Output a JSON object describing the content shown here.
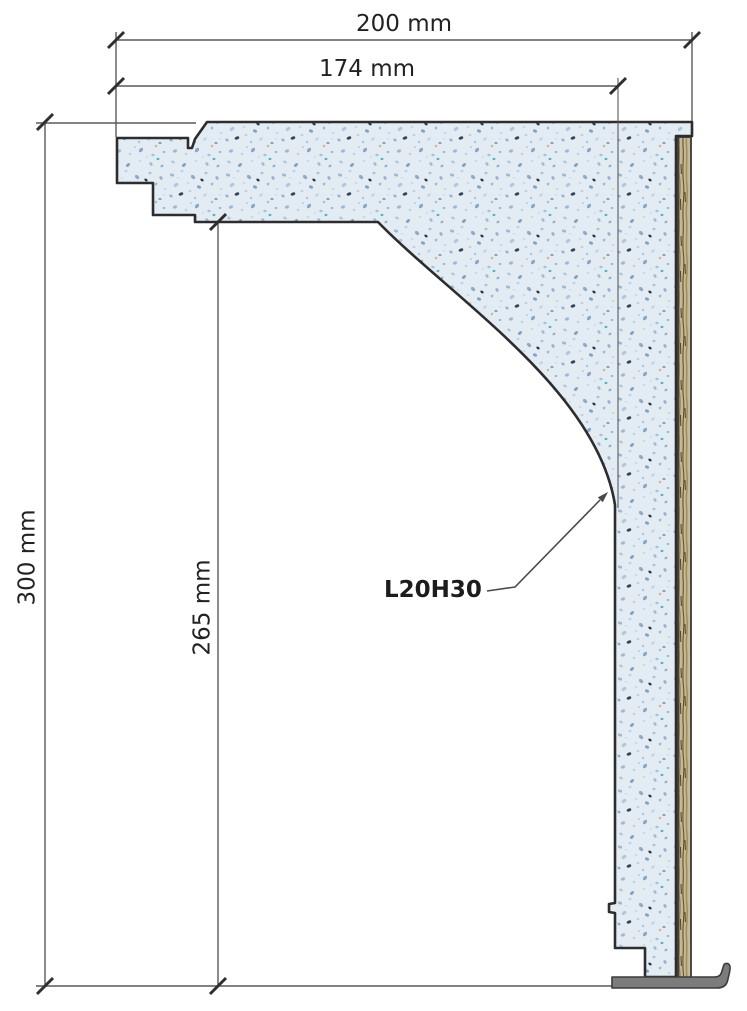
{
  "dimensions": {
    "total_width": "200 mm",
    "inner_width": "174 mm",
    "total_height": "300 mm",
    "inner_height": "265 mm"
  },
  "part_label": "L20H30",
  "colors": {
    "material_base": "#e3ebf3",
    "speckle_blue": "#8fa9c6",
    "speckle_dark": "#31455c",
    "wood_base": "#c6b88f",
    "wood_grain": "#5f5236",
    "outline": "#2d2d2d",
    "dimension_line": "#555555",
    "foot_gray": "#7c7c7c"
  }
}
